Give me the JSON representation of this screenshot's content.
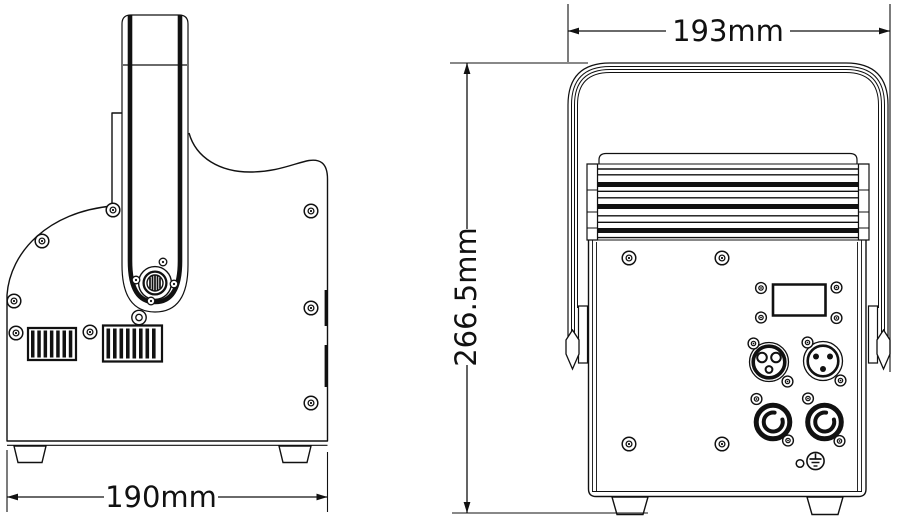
{
  "drawing": {
    "title": "stage-light-fixture-dimension-drawing",
    "labels": {
      "side_width": "190mm",
      "rear_width": "193mm",
      "rear_height": "266.5mm"
    },
    "colors": {
      "line": "#111111",
      "background": "#ffffff"
    }
  }
}
